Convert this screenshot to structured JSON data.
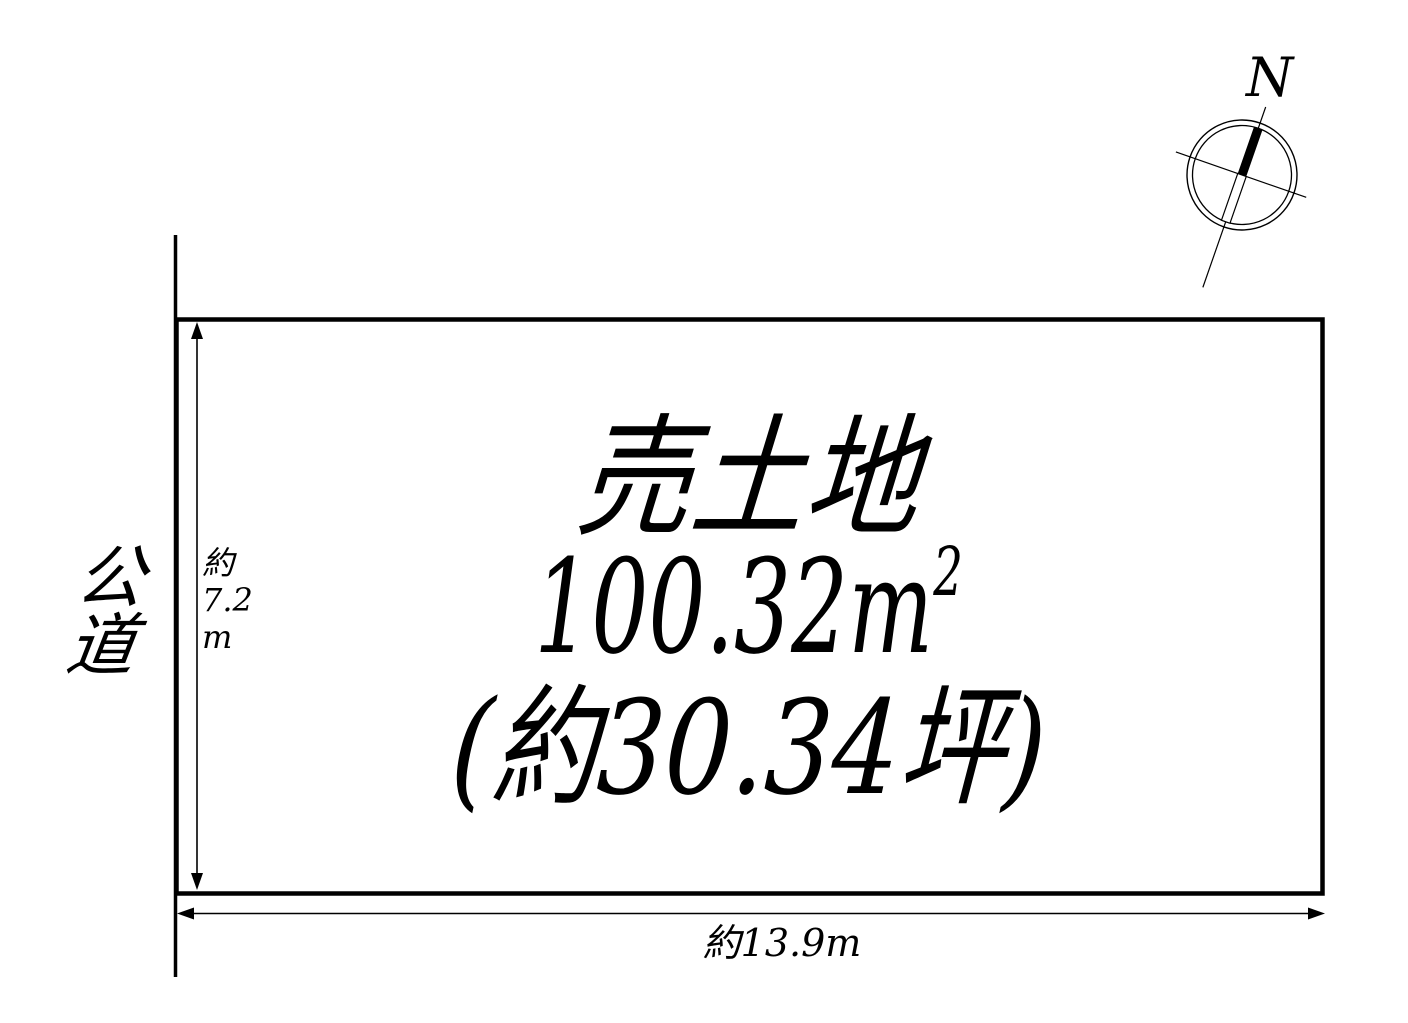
{
  "diagram": {
    "type": "land-plot-sale-diagram",
    "background_color": "#ffffff",
    "line_color": "#000000"
  },
  "compass": {
    "north_label": "N"
  },
  "road": {
    "label": "公道",
    "label_lines": [
      "公",
      "道"
    ]
  },
  "plot": {
    "title": "売土地",
    "area_value": "100.32m",
    "area_exponent": "2",
    "area_label": "100.32m²",
    "tsubo_label": "(約30.34坪)"
  },
  "dimensions": {
    "height_label": "約7.2m",
    "height_lines": [
      "約",
      "7.2",
      "m"
    ],
    "width_label": "約13.9m"
  }
}
